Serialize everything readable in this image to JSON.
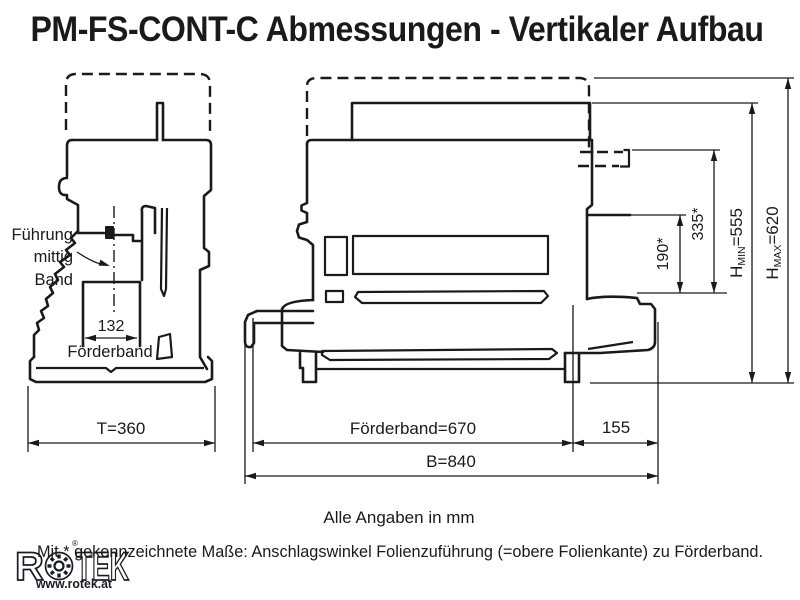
{
  "title": "PM-FS-CONT-C Abmessungen - Vertikaler Aufbau",
  "side_view": {
    "leader": {
      "line1": "Führung",
      "line2": "mittig",
      "line3": "Band"
    },
    "belt_width": "132",
    "belt_label": "Förderband",
    "depth": "T=360"
  },
  "front_view": {
    "belt_length": "Förderband=670",
    "outfeed": "155",
    "total_width": "B=840",
    "film_lower": "190*",
    "film_upper": "335*",
    "h_min": {
      "prefix": "H",
      "sub": "MIN",
      "value": "=555"
    },
    "h_max": {
      "prefix": "H",
      "sub": "MAX",
      "value": "=620"
    }
  },
  "notes": {
    "units": "Alle Angaben in mm",
    "asterisk": "Mit * gekennzeichnete Maße: Anschlagswinkel Folienzuführung (=obere Folienkante) zu Förderband."
  },
  "logo": {
    "brand_r": "R",
    "brand_tek": "TEK",
    "url": "www.rotek.at",
    "registered": "®"
  },
  "colors": {
    "ink": "#1a1a1a",
    "background": "#ffffff"
  }
}
